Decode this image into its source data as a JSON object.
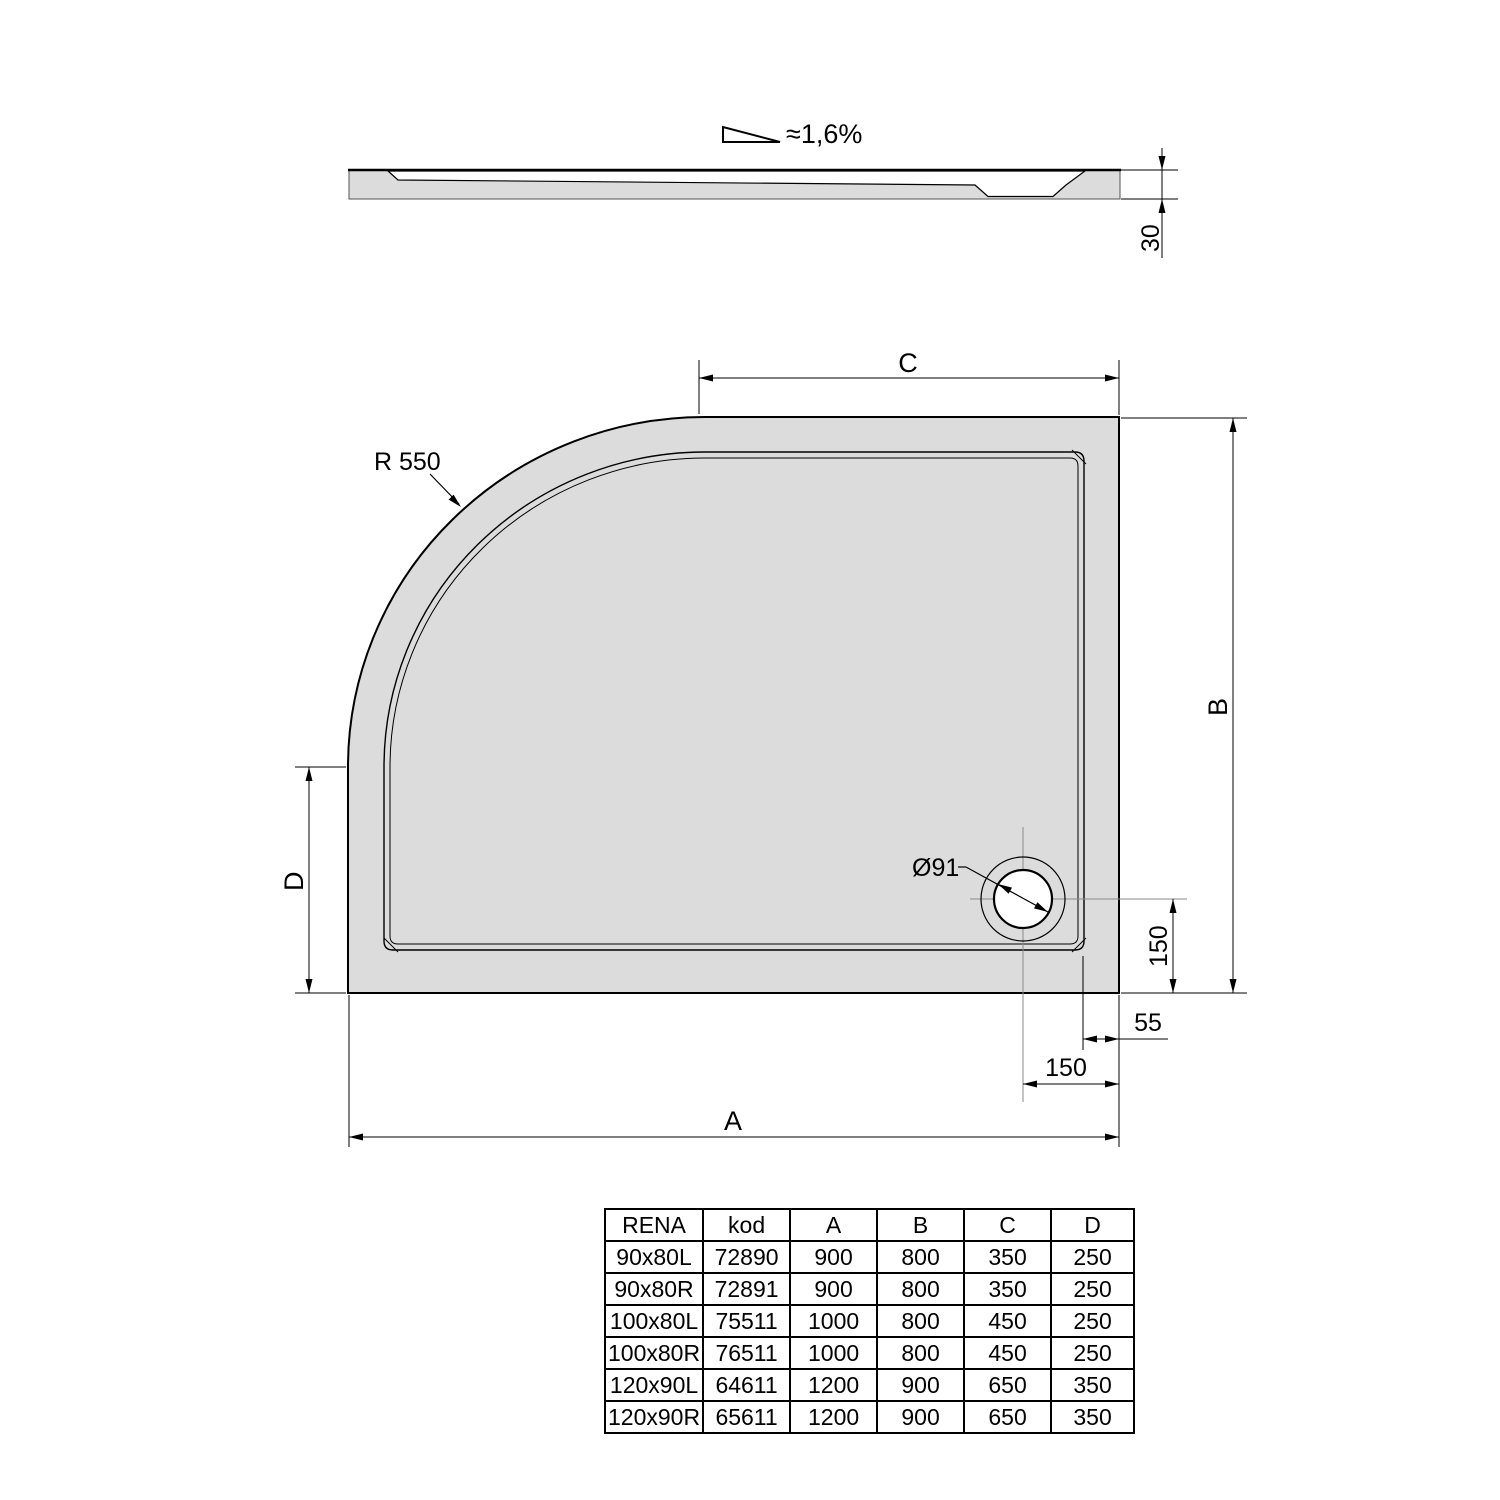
{
  "side_view": {
    "slope_label": "≈1,6%",
    "height_dim": "30"
  },
  "top_view": {
    "radius_label": "R 550",
    "drain_label": "Ø91",
    "dim_a": "A",
    "dim_b": "B",
    "dim_c": "C",
    "dim_d": "D",
    "dim_drain_to_bottom": "150",
    "dim_rim_to_edge": "55",
    "dim_drain_to_right": "150"
  },
  "table": {
    "headers": [
      "RENA",
      "kod",
      "A",
      "B",
      "C",
      "D"
    ],
    "rows": [
      [
        "90x80L",
        "72890",
        "900",
        "800",
        "350",
        "250"
      ],
      [
        "90x80R",
        "72891",
        "900",
        "800",
        "350",
        "250"
      ],
      [
        "100x80L",
        "75511",
        "1000",
        "800",
        "450",
        "250"
      ],
      [
        "100x80R",
        "76511",
        "1000",
        "800",
        "450",
        "250"
      ],
      [
        "120x90L",
        "64611",
        "1200",
        "900",
        "650",
        "350"
      ],
      [
        "120x90R",
        "65611",
        "1200",
        "900",
        "650",
        "350"
      ]
    ]
  },
  "colors": {
    "tray_fill": "#dcdcdc",
    "line": "#000000"
  }
}
